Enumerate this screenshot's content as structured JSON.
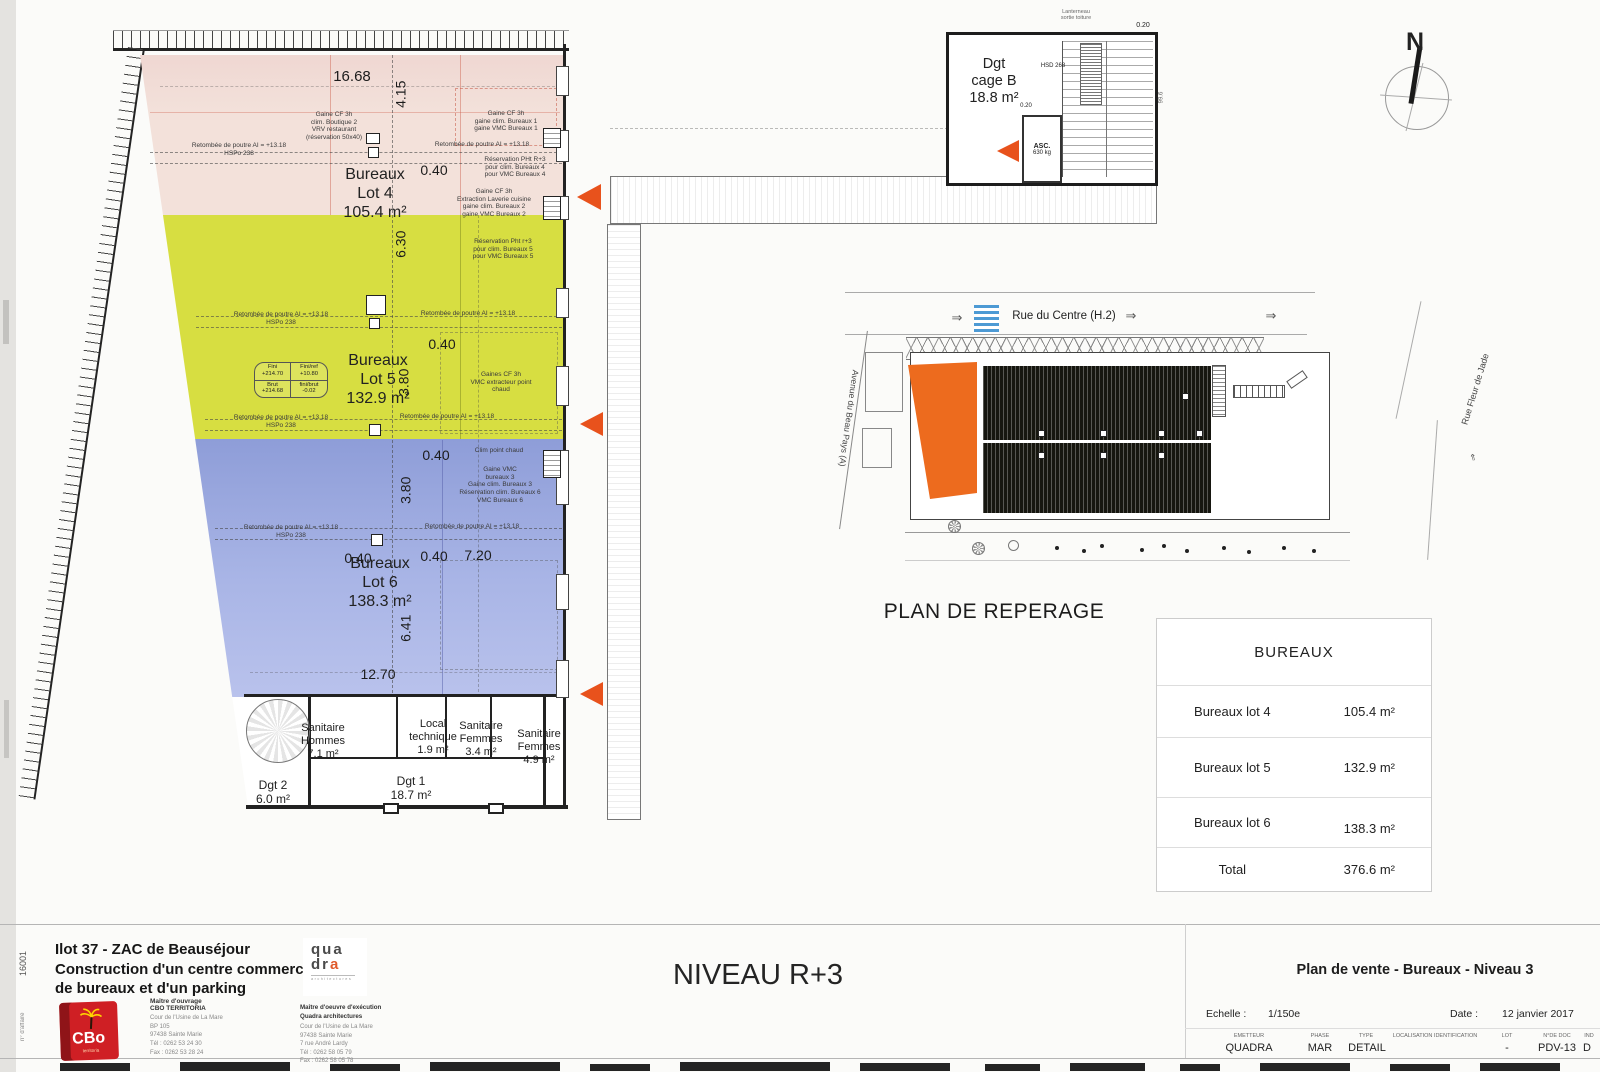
{
  "colors": {
    "lot4_fill": "#f3e1da",
    "lot5_fill": "#d7de41",
    "lot6_fill": "#98a6dc",
    "accent_triangle": "#e8521c",
    "site_highlight": "#ed6b1e",
    "crosswalk_blue": "#4d9ad4",
    "logo_red": "#cf1f24"
  },
  "plan": {
    "lots": [
      {
        "label": "Bureaux\nLot 4\n105.4 m²"
      },
      {
        "label": "Bureaux\nLot 5\n132.9 m²"
      },
      {
        "label": "Bureaux\nLot 6\n138.3 m²"
      }
    ],
    "dims": {
      "w_top": "16.68",
      "h1": "4.15",
      "g1": "0.40",
      "h2": "6.30",
      "g2": "0.40",
      "h3": "3.80",
      "g3": "0.40",
      "h4": "3.80",
      "g4": "0.40",
      "g5": "0.40",
      "w2": "7.20",
      "h5": "6.41",
      "w_bot": "12.70"
    },
    "levels": {
      "fini": "Fini\n+214.70",
      "finiref": "Fini/ref\n+10.80",
      "brut": "Brut\n+214.68",
      "finibrut": "fini/brut\n-0.02"
    },
    "annotations": {
      "gaine_boutique": "Gaine CF 3h\nclim. Boutique 2\nVRV restaurant\n(réservation 50x40)",
      "retombee_hspo": "Retombée de poutre AI = +13.18\nHSPo 238",
      "retombee": "Retombée de poutre AI = +13.18",
      "gaine_b1": "Gaine CF 3h\ngaine clim. Bureaux 1\ngaine VMC Bureaux 1",
      "resa_b4": "Réservation PHt R+3\npour clim. Bureaux 4\npour VMC Bureaux 4",
      "gaine_b2": "Gaine CF 3h\nExtraction Laverie cuisine\ngaine clim. Bureaux 2\ngaine VMC Bureaux 2",
      "resa_b5": "Réservation Pht r+3\npour clim. Bureaux 5\npour VMC Bureaux 5",
      "gaines_vmc": "Gaines CF 3h\nVMC extracteur point\nchaud",
      "clim_chaud": "Clim point chaud",
      "gaine_b3": "Gaine VMC\nbureaux 3\nGaine clim. Bureaux 3\nRéservation clim. Bureaux 6\nVMC Bureaux 6"
    },
    "rooms": {
      "san_hommes": "Sanitaire\nHommes\n7.1 m²",
      "local_technique": "Local\ntechnique\n1.9 m²",
      "san_femmes1": "Sanitaire\nFemmes\n3.4 m²",
      "san_femmes2": "Sanitaire\nFemmes\n4.9 m²",
      "dgt2": "Dgt 2\n6.0 m²",
      "dgt1": "Dgt 1\n18.7 m²"
    }
  },
  "cage_b": {
    "label": "Dgt\ncage B\n18.8 m²",
    "hsd": "HSD  268",
    "asc": "ASC.",
    "asc_load": "630 kg",
    "roof_note": "Lanterneau\nsortie toiture",
    "dim_a": "0.20",
    "dim_b": "0.20",
    "dim_c": "99.6"
  },
  "north": {
    "label": "N"
  },
  "site": {
    "title": "PLAN DE REPERAGE",
    "street_top": "Rue du Centre (H.2)",
    "street_left": "Avenue du Beau Pays (A)",
    "street_right": "Rue Fleur de Jade",
    "arrow_right": "⇒",
    "arrow_left": "⇐"
  },
  "table": {
    "title": "BUREAUX",
    "rows": [
      {
        "label": "Bureaux lot 4",
        "value": "105.4 m²"
      },
      {
        "label": "Bureaux lot 5",
        "value": "132.9 m²"
      },
      {
        "label": "Bureaux lot 6",
        "value": "138.3 m²"
      },
      {
        "label": "Total",
        "value": "376.6 m²"
      }
    ]
  },
  "titleblock": {
    "level": "NIVEAU R+3",
    "project_no": "16001",
    "affaire_label": "n° d'affaire",
    "project": "Ilot 37 - ZAC de Beauséjour\nConstruction d'un centre commercial,\nde bureaux et d'un parking",
    "cbo_logo": "CBo",
    "cbo_logo_sub": "territoria",
    "cbo_role": "Maître d'ouvrage",
    "cbo_name": "CBO TERRITORIA",
    "cbo_addr": "Cour de l'Usine de La Mare\nBP 105\n97438 Sainte Marie\nTél : 0262 53 24 30\nFax : 0262 53 28 24",
    "quadra_logo_1": "qua",
    "quadra_logo_2a": "dr",
    "quadra_logo_2b": "a",
    "quadra_sub": "architectures",
    "quadra_role": "Maître d'oeuvre d'exécution\nQuadra architectures",
    "quadra_addr": "Cour de l'Usine de La Mare\n97438 Sainte Marie\n7 rue André Lardy\nTél : 0262 58 05 79\nFax : 0262 58 05 78",
    "drawing_title": "Plan de vente - Bureaux - Niveau 3",
    "scale_label": "Echelle :",
    "scale": "1/150e",
    "date_label": "Date :",
    "date": "12 janvier 2017",
    "emetteur_label": "EMETTEUR",
    "emetteur": "QUADRA",
    "phase_label": "PHASE",
    "phase": "MAR",
    "type_label": "TYPE",
    "type": "DETAIL",
    "loc_label": "LOCALISATION IDENTIFICATION",
    "lot_label": "LOT",
    "lot": "-",
    "doc_label": "N°DE DOC",
    "doc": "PDV-13",
    "ind_label": "IND",
    "ind": "D"
  }
}
